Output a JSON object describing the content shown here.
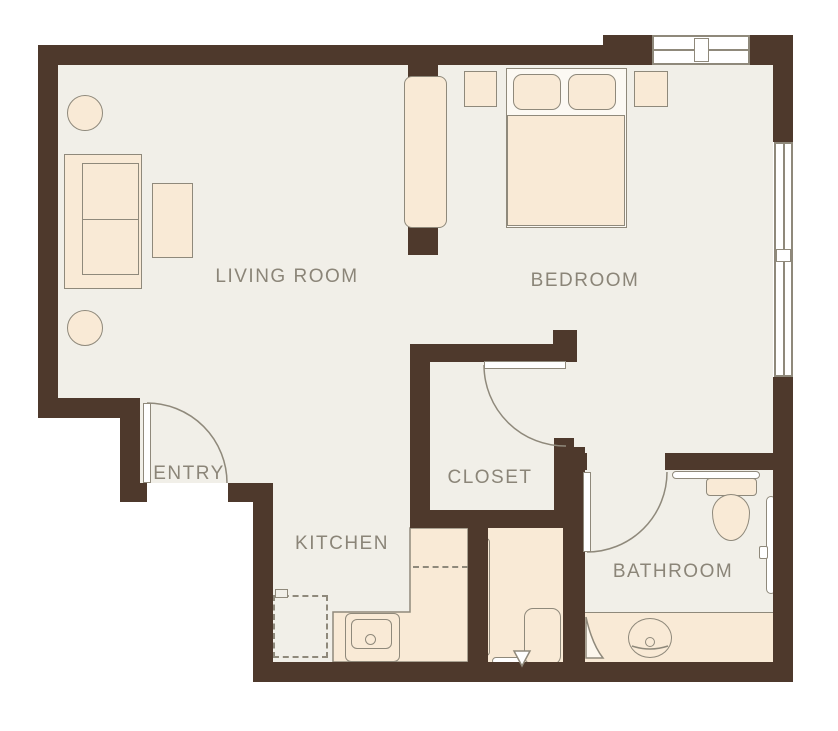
{
  "plan": {
    "type": "apartment-floor-plan",
    "rooms": [
      {
        "id": "living-room",
        "label": "LIVING ROOM"
      },
      {
        "id": "bedroom",
        "label": "BEDROOM"
      },
      {
        "id": "entry",
        "label": "ENTRY"
      },
      {
        "id": "closet",
        "label": "CLOSET"
      },
      {
        "id": "kitchen",
        "label": "KITCHEN"
      },
      {
        "id": "bathroom",
        "label": "BATHROOM"
      }
    ]
  },
  "colors": {
    "wall": "#4e392c",
    "floor": "#f1efe8",
    "fill": "#f9ead6",
    "line": "#8f897b",
    "label_text": "#8b8578",
    "door_fill": "#ffffff",
    "bg": "#ffffff"
  }
}
